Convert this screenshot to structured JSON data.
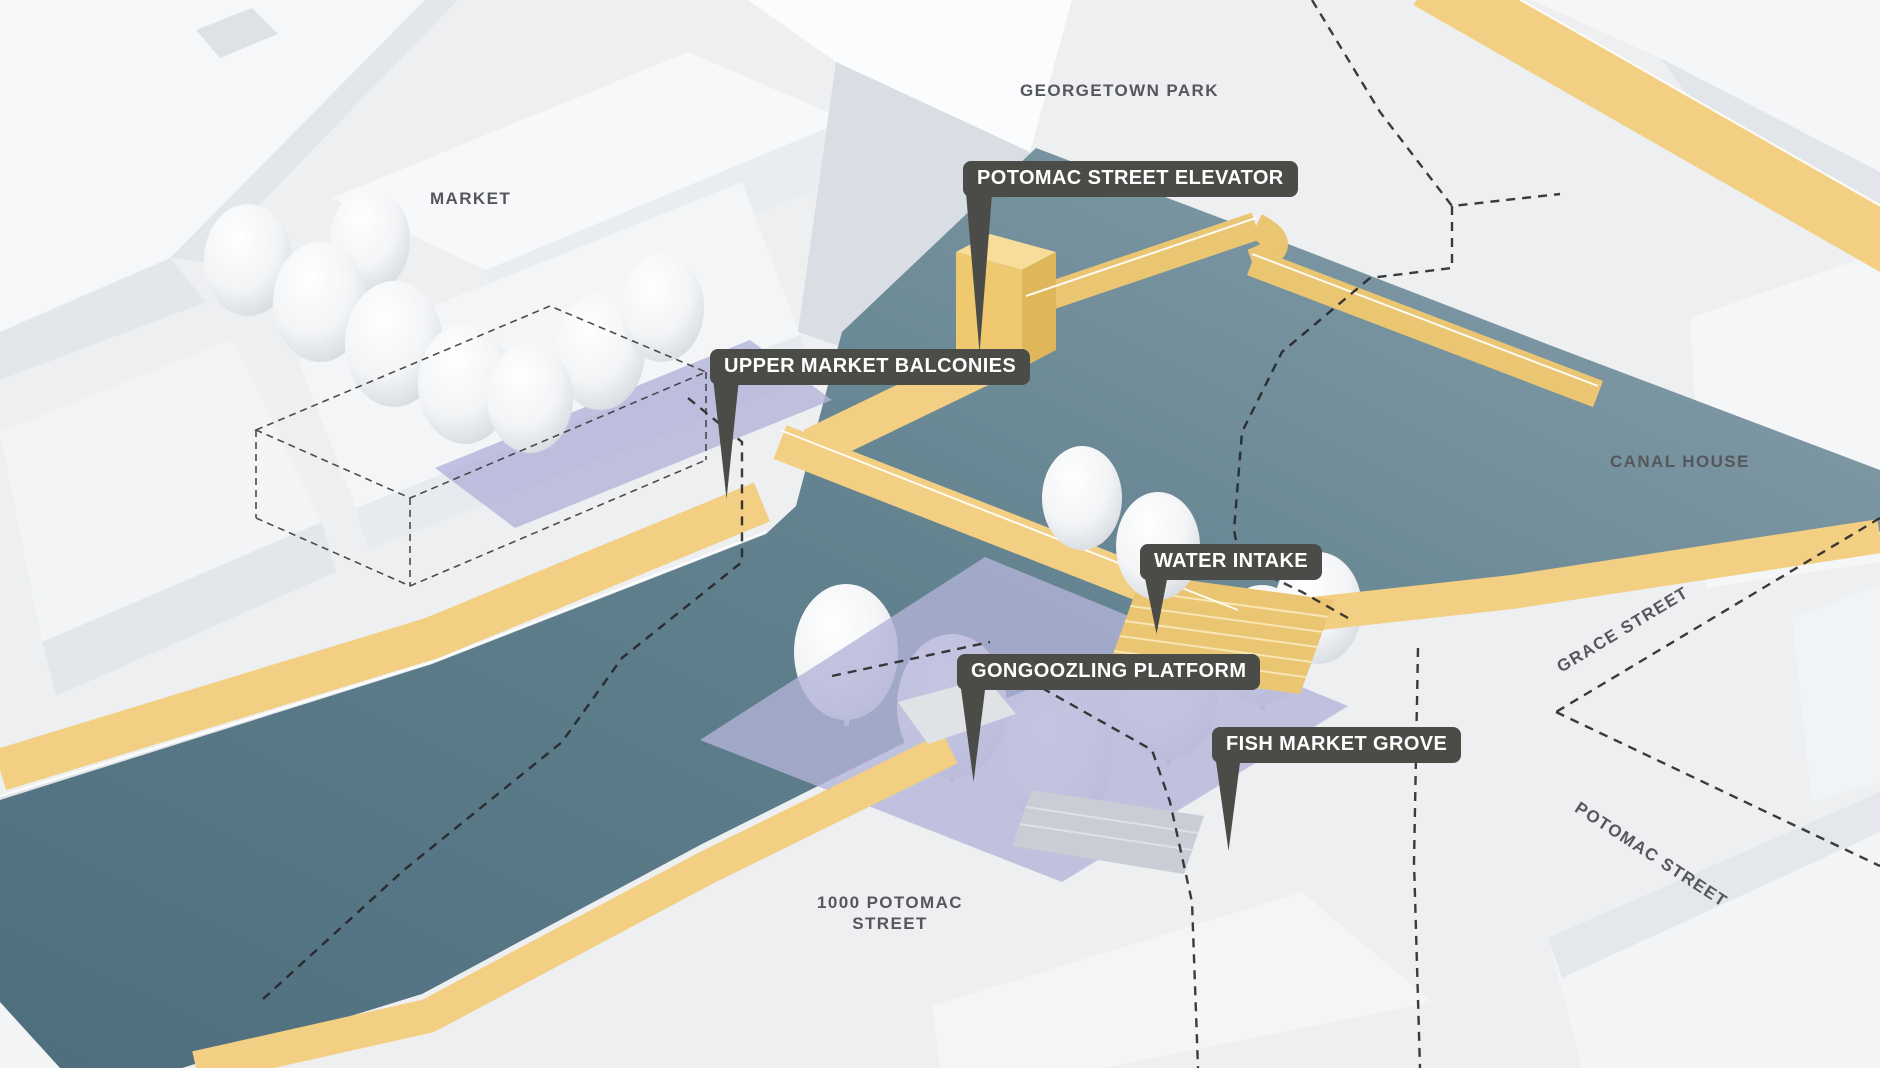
{
  "diagram": {
    "type": "axonometric-site-diagram",
    "area_labels": [
      {
        "id": "market",
        "text": "MARKET"
      },
      {
        "id": "georgetown-park",
        "text": "GEORGETOWN PARK"
      },
      {
        "id": "canal-house",
        "text": "CANAL HOUSE"
      },
      {
        "id": "grace-street",
        "text": "GRACE STREET"
      },
      {
        "id": "potomac-street",
        "text": "POTOMAC STREET"
      },
      {
        "id": "building-1000-potomac",
        "text": "1000 POTOMAC STREET"
      }
    ],
    "callouts": [
      {
        "id": "potomac-street-elevator",
        "text": "POTOMAC STREET ELEVATOR"
      },
      {
        "id": "upper-market-balconies",
        "text": "UPPER MARKET BALCONIES"
      },
      {
        "id": "water-intake",
        "text": "WATER INTAKE"
      },
      {
        "id": "gongoozling-platform",
        "text": "GONGOOZLING PLATFORM"
      },
      {
        "id": "fish-market-grove",
        "text": "FISH MARKET GROVE"
      }
    ],
    "colors": {
      "bg": "#edeff1",
      "water-dark": "#4e6e7e",
      "water-mid": "#63828f",
      "water-light": "#8aa2ae",
      "path": "#f2cf82",
      "path-deep": "#eac572",
      "overlay": "#b3b3d9",
      "tag-bg": "#4b4b47",
      "tag-text": "#ffffff",
      "label-gray": "#55575b"
    }
  }
}
